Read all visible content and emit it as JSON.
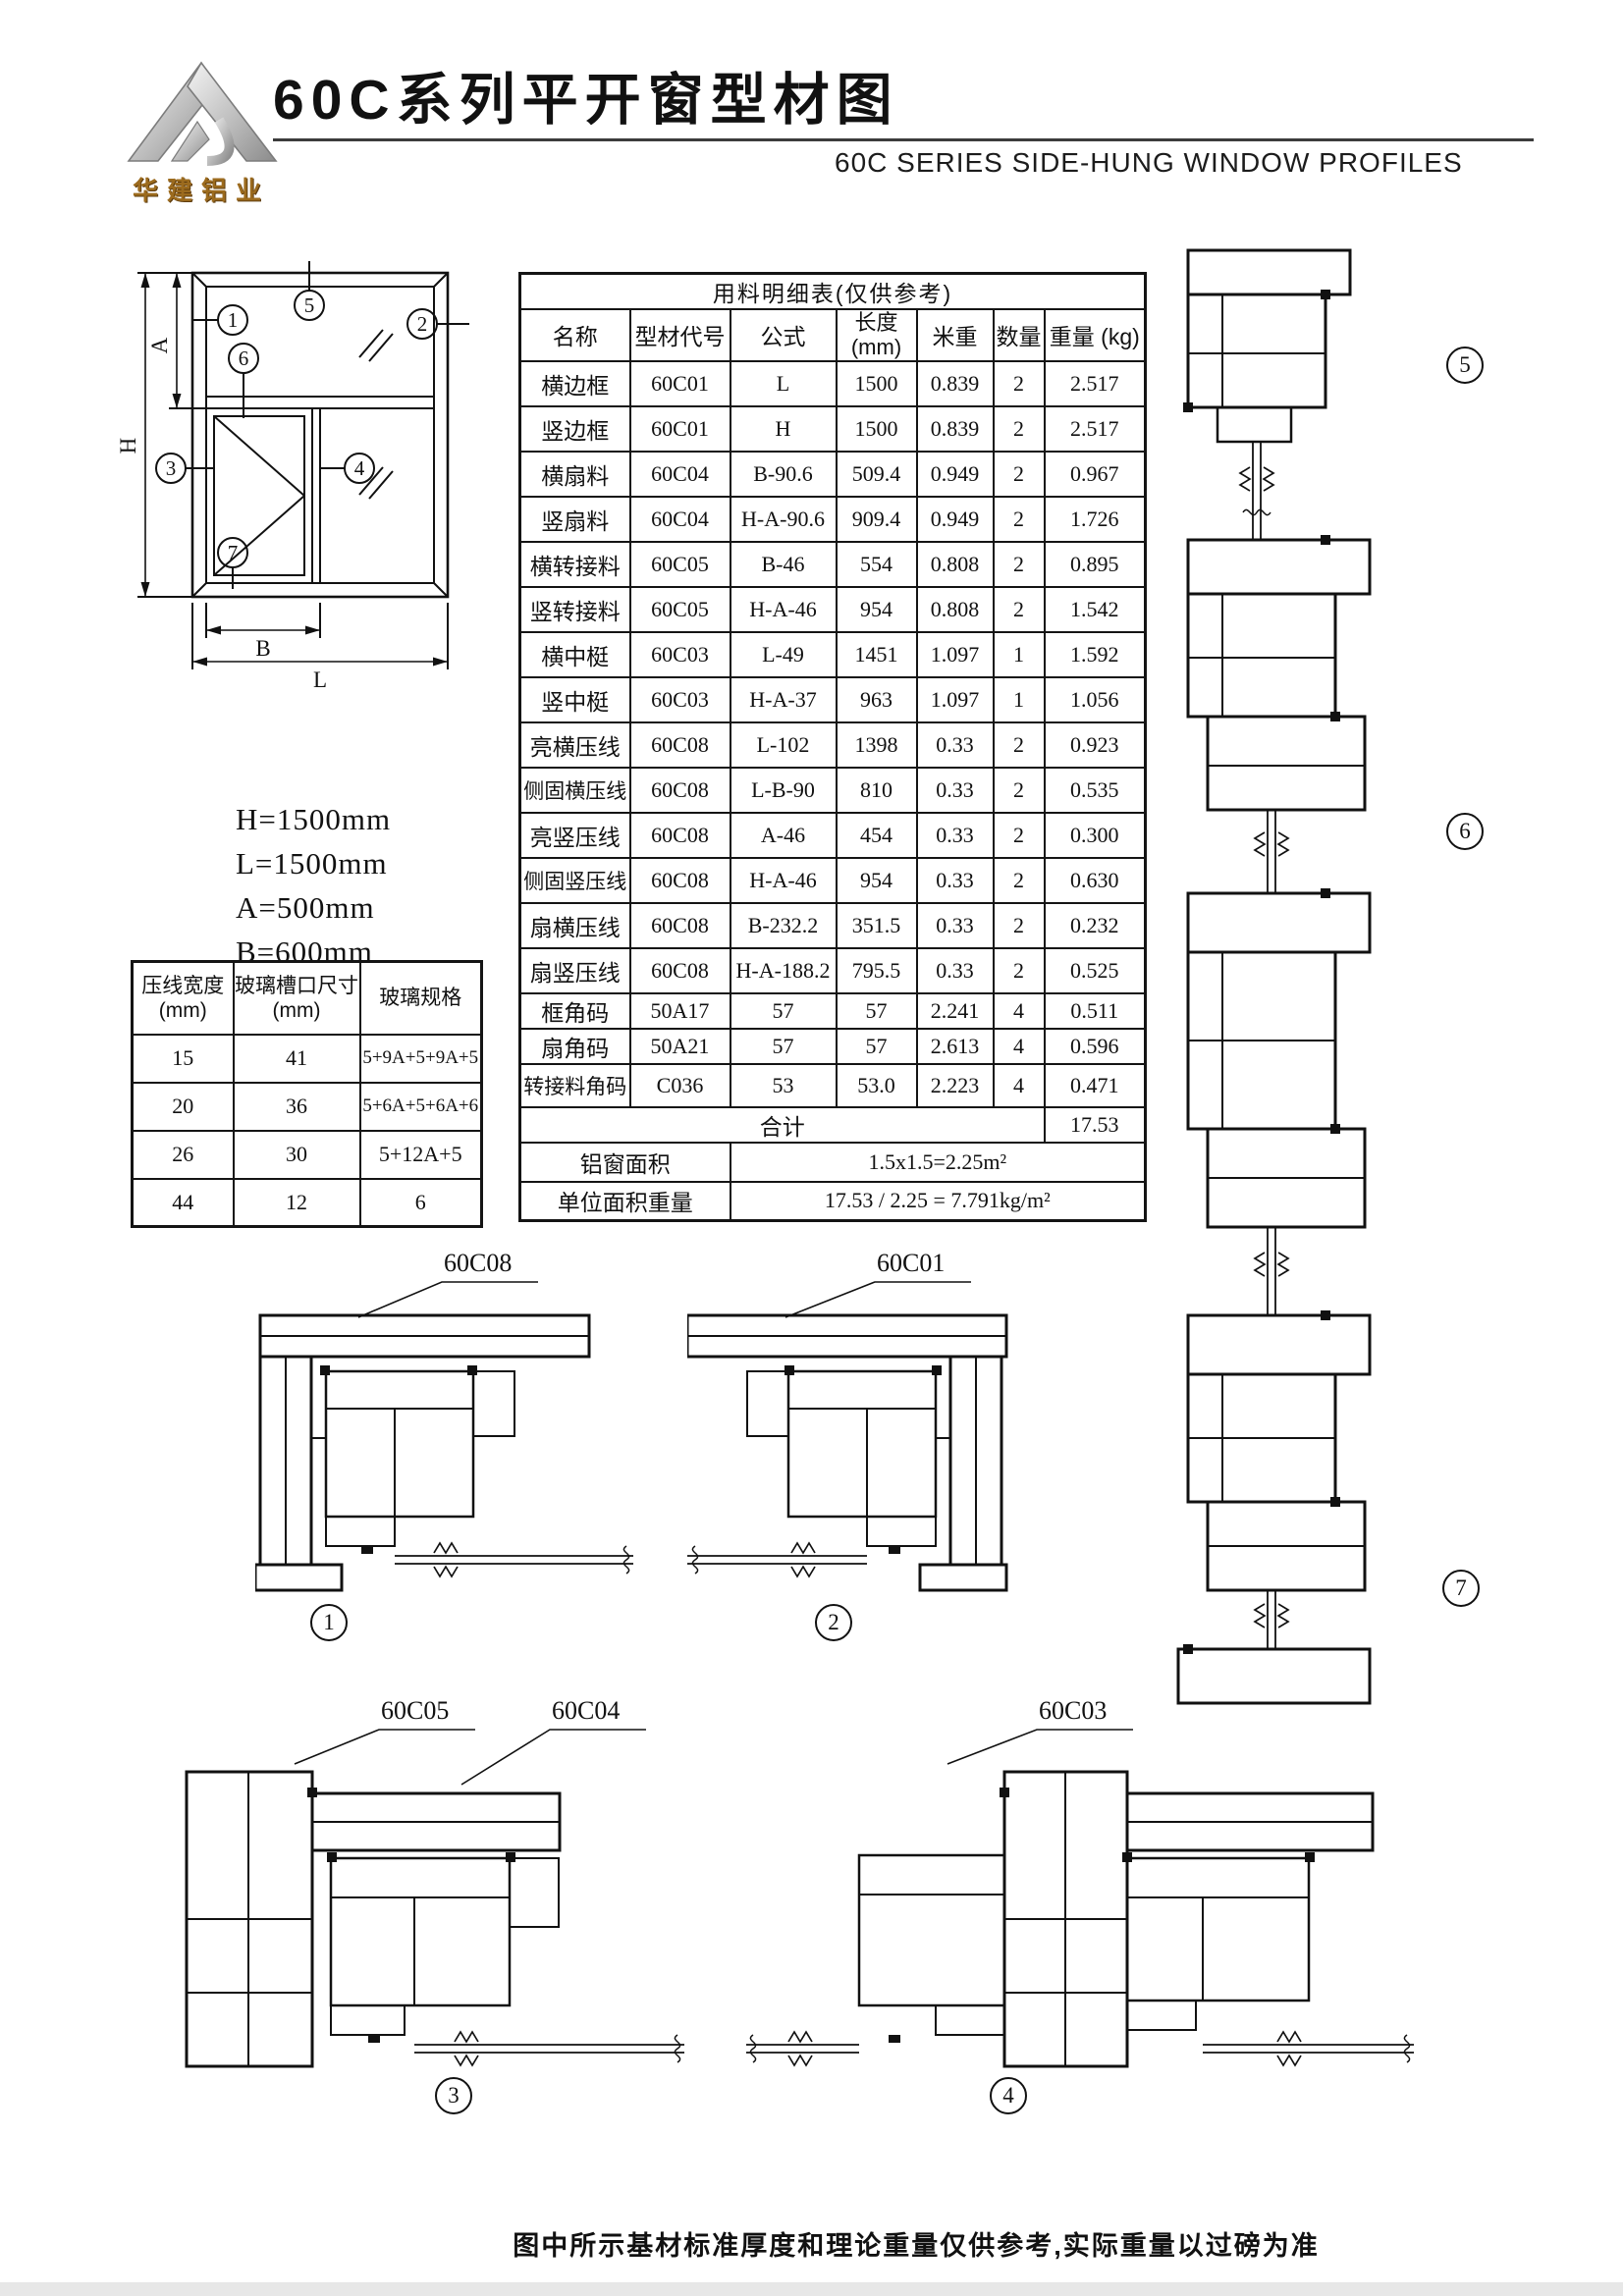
{
  "header": {
    "logo_text": "华建铝业",
    "title": "60C系列平开窗型材图",
    "subtitle": "60C SERIES SIDE-HUNG WINDOW PROFILES"
  },
  "window_diagram": {
    "dim_h": "H",
    "dim_a": "A",
    "dim_b": "B",
    "dim_l": "L"
  },
  "callouts": [
    "1",
    "2",
    "3",
    "4",
    "5",
    "6",
    "7"
  ],
  "dimension_notes": [
    "H=1500mm",
    "L=1500mm",
    "A=500mm",
    "B=600mm"
  ],
  "materials_table": {
    "title": "用料明细表(仅供参考)",
    "columns": [
      "名称",
      "型材代号",
      "公式",
      "长度\n(mm)",
      "米重",
      "数量",
      "重量 (kg)"
    ],
    "rows": [
      [
        "横边框",
        "60C01",
        "L",
        "1500",
        "0.839",
        "2",
        "2.517"
      ],
      [
        "竖边框",
        "60C01",
        "H",
        "1500",
        "0.839",
        "2",
        "2.517"
      ],
      [
        "横扇料",
        "60C04",
        "B-90.6",
        "509.4",
        "0.949",
        "2",
        "0.967"
      ],
      [
        "竖扇料",
        "60C04",
        "H-A-90.6",
        "909.4",
        "0.949",
        "2",
        "1.726"
      ],
      [
        "横转接料",
        "60C05",
        "B-46",
        "554",
        "0.808",
        "2",
        "0.895"
      ],
      [
        "竖转接料",
        "60C05",
        "H-A-46",
        "954",
        "0.808",
        "2",
        "1.542"
      ],
      [
        "横中梃",
        "60C03",
        "L-49",
        "1451",
        "1.097",
        "1",
        "1.592"
      ],
      [
        "竖中梃",
        "60C03",
        "H-A-37",
        "963",
        "1.097",
        "1",
        "1.056"
      ],
      [
        "亮横压线",
        "60C08",
        "L-102",
        "1398",
        "0.33",
        "2",
        "0.923"
      ],
      [
        "侧固横压线",
        "60C08",
        "L-B-90",
        "810",
        "0.33",
        "2",
        "0.535"
      ],
      [
        "亮竖压线",
        "60C08",
        "A-46",
        "454",
        "0.33",
        "2",
        "0.300"
      ],
      [
        "侧固竖压线",
        "60C08",
        "H-A-46",
        "954",
        "0.33",
        "2",
        "0.630"
      ],
      [
        "扇横压线",
        "60C08",
        "B-232.2",
        "351.5",
        "0.33",
        "2",
        "0.232"
      ],
      [
        "扇竖压线",
        "60C08",
        "H-A-188.2",
        "795.5",
        "0.33",
        "2",
        "0.525"
      ],
      [
        "框角码",
        "50A17",
        "57",
        "57",
        "2.241",
        "4",
        "0.511"
      ],
      [
        "扇角码",
        "50A21",
        "57",
        "57",
        "2.613",
        "4",
        "0.596"
      ],
      [
        "转接料角码",
        "C036",
        "53",
        "53.0",
        "2.223",
        "4",
        "0.471"
      ]
    ],
    "total_label": "合计",
    "total_value": "17.53",
    "area_label": "铝窗面积",
    "area_value": "1.5x1.5=2.25m²",
    "unit_weight_label": "单位面积重量",
    "unit_weight_value": "17.53 / 2.25 = 7.791kg/m²"
  },
  "glass_table": {
    "columns": [
      "压线宽度\n(mm)",
      "玻璃槽口尺寸\n(mm)",
      "玻璃规格"
    ],
    "rows": [
      [
        "15",
        "41",
        "5+9A+5+9A+5"
      ],
      [
        "20",
        "36",
        "5+6A+5+6A+6"
      ],
      [
        "26",
        "30",
        "5+12A+5"
      ],
      [
        "44",
        "12",
        "6"
      ]
    ]
  },
  "profile_labels": [
    "60C08",
    "60C01",
    "60C05",
    "60C04",
    "60C03"
  ],
  "footer_note": "图中所示基材标准厚度和理论重量仅供参考,实际重量以过磅为准"
}
